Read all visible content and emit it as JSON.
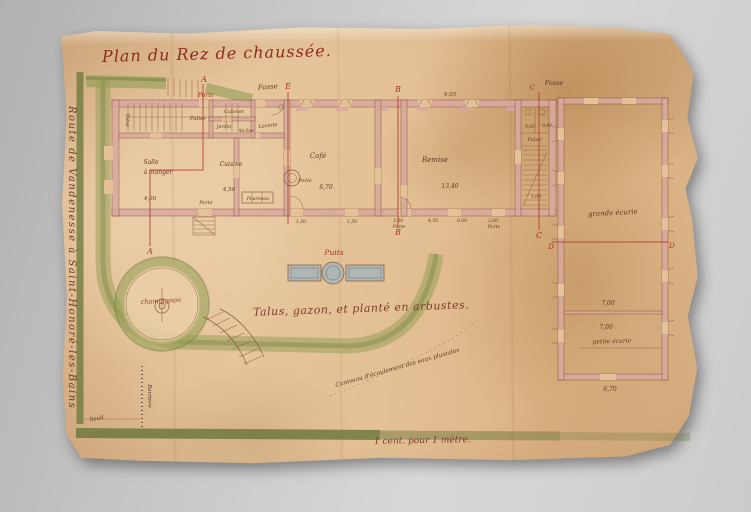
{
  "title": "Plan du Rez de chaussée.",
  "margin_note": "Route de Vandenesse à Saint-Honoré-les-Bains",
  "lawn_note": "Talus, gazon, et planté en arbustes.",
  "scale_note": "1 cent. pour 1 mètre.",
  "colors": {
    "red_ink": "#a8322a",
    "brown_ink": "#5d3b24",
    "wall_pink": "#d9a9a0",
    "hedge_green": "#97a057",
    "paper": "#e4c198",
    "water_gray": "#a9b6bc"
  },
  "plan_labels": [
    {
      "name": "section-a-top",
      "text": "A",
      "x": 204,
      "y": 82,
      "size": 8,
      "ink": "red"
    },
    {
      "name": "porte-red-label",
      "text": "Porte",
      "x": 206,
      "y": 97,
      "size": 6,
      "ink": "red"
    },
    {
      "name": "section-a-bottom",
      "text": "A",
      "x": 150,
      "y": 254,
      "size": 8,
      "ink": "red"
    },
    {
      "name": "section-e-top",
      "text": "E",
      "x": 288,
      "y": 89,
      "size": 8,
      "ink": "red"
    },
    {
      "name": "section-b-top",
      "text": "B",
      "x": 398,
      "y": 92,
      "size": 8,
      "ink": "red"
    },
    {
      "name": "section-b-bottom",
      "text": "B",
      "x": 398,
      "y": 235,
      "size": 8,
      "ink": "red"
    },
    {
      "name": "section-c-top",
      "text": "C",
      "x": 532,
      "y": 90,
      "size": 7,
      "ink": "red"
    },
    {
      "name": "section-c-bottom",
      "text": "C",
      "x": 539,
      "y": 238,
      "size": 8,
      "ink": "red"
    },
    {
      "name": "section-d-left",
      "text": "D",
      "x": 551,
      "y": 249,
      "size": 7,
      "ink": "red"
    },
    {
      "name": "section-d-right",
      "text": "D",
      "x": 672,
      "y": 248,
      "size": 7,
      "ink": "red"
    },
    {
      "name": "puits-label",
      "text": "Puits",
      "x": 334,
      "y": 255,
      "size": 7.5,
      "ink": "red"
    },
    {
      "name": "champignon-label",
      "text": "champignon",
      "x": 161,
      "y": 303,
      "size": 6.5,
      "ink": "red",
      "rot": -3
    },
    {
      "name": "fosse-label-left",
      "text": "Fosse",
      "x": 268,
      "y": 89,
      "size": 7,
      "ink": "brown",
      "rot": -5
    },
    {
      "name": "fosse-label-right",
      "text": "Fosse",
      "x": 554,
      "y": 85,
      "size": 6.5,
      "ink": "brown"
    },
    {
      "name": "palier-label-left",
      "text": "Palier",
      "x": 198,
      "y": 120,
      "size": 5.5,
      "ink": "brown"
    },
    {
      "name": "cabinet-label",
      "text": "Cabinet",
      "x": 234,
      "y": 113,
      "size": 5,
      "ink": "brown"
    },
    {
      "name": "jardin-label",
      "text": "Jardin",
      "x": 224,
      "y": 128,
      "size": 4.8,
      "ink": "brown"
    },
    {
      "name": "alcove-label",
      "text": "Alcôve",
      "x": 246,
      "y": 132,
      "size": 4.8,
      "ink": "brown"
    },
    {
      "name": "laverie-label",
      "text": "Laverie",
      "x": 268,
      "y": 127,
      "size": 5,
      "ink": "brown",
      "rot": -6
    },
    {
      "name": "talus-wall-label",
      "text": "Talus",
      "x": 126,
      "y": 120,
      "size": 5,
      "ink": "brown",
      "rot": 90
    },
    {
      "name": "salle-label",
      "text": "Salle",
      "x": 151,
      "y": 164,
      "size": 6,
      "ink": "brown"
    },
    {
      "name": "a-manger-label",
      "text": "à manger",
      "x": 158,
      "y": 174,
      "size": 6,
      "ink": "brown"
    },
    {
      "name": "salle-dim",
      "text": "4,00",
      "x": 150,
      "y": 200,
      "size": 5.5,
      "ink": "brown"
    },
    {
      "name": "cuisine-label",
      "text": "Cuisine",
      "x": 231,
      "y": 166,
      "size": 6,
      "ink": "brown"
    },
    {
      "name": "cuisine-dim",
      "text": "4,50",
      "x": 229,
      "y": 191,
      "size": 5.5,
      "ink": "brown"
    },
    {
      "name": "fourneau-label",
      "text": "Fourneau",
      "x": 258,
      "y": 200,
      "size": 4.6,
      "ink": "brown"
    },
    {
      "name": "porte-label-cuisine",
      "text": "Porte",
      "x": 206,
      "y": 204,
      "size": 5,
      "ink": "brown"
    },
    {
      "name": "cafe-label",
      "text": "Café",
      "x": 318,
      "y": 158,
      "size": 7,
      "ink": "brown"
    },
    {
      "name": "cafe-dim",
      "text": "6,70",
      "x": 326,
      "y": 189,
      "size": 6,
      "ink": "brown"
    },
    {
      "name": "poele-label",
      "text": "Poêle",
      "x": 305,
      "y": 182,
      "size": 5,
      "ink": "brown"
    },
    {
      "name": "remise-label",
      "text": "Remise",
      "x": 435,
      "y": 162,
      "size": 7,
      "ink": "brown"
    },
    {
      "name": "remise-dim",
      "text": "13,40",
      "x": 450,
      "y": 188,
      "size": 6,
      "ink": "brown"
    },
    {
      "name": "remise-top-dim",
      "text": "9,05",
      "x": 450,
      "y": 96,
      "size": 5.5,
      "ink": "brown"
    },
    {
      "name": "palier-label-right",
      "text": "Palier",
      "x": 535,
      "y": 141,
      "size": 5,
      "ink": "brown"
    },
    {
      "name": "stair-dim-1",
      "text": "0,60",
      "x": 530,
      "y": 128,
      "size": 4.4,
      "ink": "brown"
    },
    {
      "name": "stair-dim-2",
      "text": "0,40",
      "x": 547,
      "y": 127,
      "size": 4.4,
      "ink": "brown"
    },
    {
      "name": "stair-dim-3",
      "text": "1,00",
      "x": 536,
      "y": 198,
      "size": 4.4,
      "ink": "brown"
    },
    {
      "name": "grande-ecurie-label",
      "text": "grande écurie",
      "x": 613,
      "y": 215,
      "size": 7,
      "ink": "brown",
      "rot": -3
    },
    {
      "name": "ecurie-dim-1",
      "text": "7,00",
      "x": 608,
      "y": 305,
      "size": 6,
      "ink": "brown"
    },
    {
      "name": "ecurie-dim-2",
      "text": "7,00",
      "x": 606,
      "y": 329,
      "size": 6,
      "ink": "brown"
    },
    {
      "name": "petite-ecurie-label",
      "text": "petite écurie",
      "x": 612,
      "y": 343,
      "size": 6,
      "ink": "brown",
      "rot": -2
    },
    {
      "name": "petite-ecurie-dim",
      "text": "6,70",
      "x": 610,
      "y": 391,
      "size": 6,
      "ink": "brown"
    },
    {
      "name": "cafe-door-dim-1",
      "text": "1,50",
      "x": 301,
      "y": 223,
      "size": 4.6,
      "ink": "brown"
    },
    {
      "name": "cafe-door-dim-2",
      "text": "1,50",
      "x": 352,
      "y": 223,
      "size": 4.6,
      "ink": "brown"
    },
    {
      "name": "remise-door-dim-1",
      "text": "3,00",
      "x": 398,
      "y": 222,
      "size": 4.6,
      "ink": "brown"
    },
    {
      "name": "remise-porte-label-1",
      "text": "Porte",
      "x": 399,
      "y": 228,
      "size": 4.6,
      "ink": "brown"
    },
    {
      "name": "remise-door-dim-2",
      "text": "4,50",
      "x": 433,
      "y": 222,
      "size": 4.6,
      "ink": "brown"
    },
    {
      "name": "remise-door-dim-3",
      "text": "0,60",
      "x": 462,
      "y": 222,
      "size": 4.6,
      "ink": "brown"
    },
    {
      "name": "remise-door-dim-4",
      "text": "3,00",
      "x": 493,
      "y": 222,
      "size": 4.6,
      "ink": "brown"
    },
    {
      "name": "remise-porte-label-2",
      "text": "Porte",
      "x": 494,
      "y": 228,
      "size": 4.6,
      "ink": "brown"
    },
    {
      "name": "barriere-label",
      "text": "Barrière",
      "x": 148,
      "y": 396,
      "size": 5.5,
      "ink": "brown",
      "rot": 90
    },
    {
      "name": "seuil-label",
      "text": "Seuil",
      "x": 97,
      "y": 420,
      "size": 5.5,
      "ink": "brown",
      "rot": -10
    },
    {
      "name": "caniveau-label",
      "text": "Caniveau d'écoulement des eaux pluviales",
      "x": 336,
      "y": 387,
      "size": 6,
      "ink": "brown",
      "rot": -16,
      "anchor": "start"
    }
  ]
}
